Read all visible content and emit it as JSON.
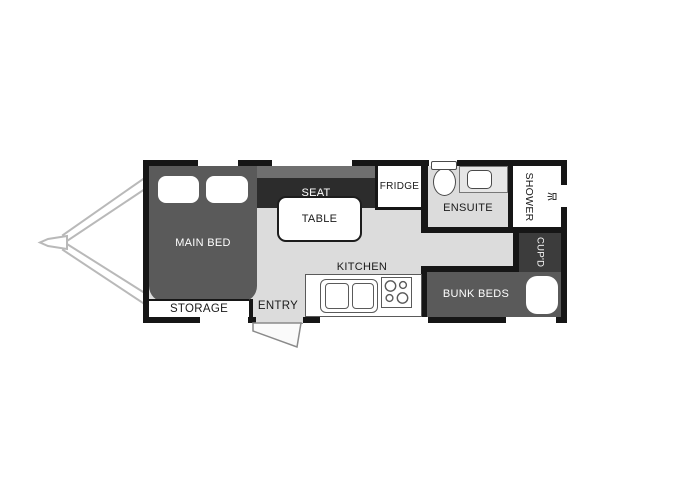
{
  "title": "Caravan Floor Plan",
  "colors": {
    "wall": "#161616",
    "floor": "#dcdcdc",
    "bed_fill": "#5a5a5a",
    "seat_fill": "#2c2c2c",
    "seat_back_fill": "#6f6f6f",
    "cupboard_fill": "#3c3c3c",
    "fixture_fill": "#ffffff",
    "hitch_stroke": "#b9b9b9"
  },
  "rooms": {
    "main_bed": {
      "label": "MAIN BED"
    },
    "storage": {
      "label": "STORAGE"
    },
    "entry": {
      "label": "ENTRY"
    },
    "seat": {
      "label": "SEAT"
    },
    "table": {
      "label": "TABLE"
    },
    "fridge": {
      "label": "FRIDGE"
    },
    "kitchen": {
      "label": "KITCHEN"
    },
    "ensuite": {
      "label": "ENSUITE"
    },
    "shower": {
      "label": "SHOWER"
    },
    "cupboard": {
      "label": "CUP'D"
    },
    "bunk_beds": {
      "label": "BUNK BEDS"
    }
  },
  "icons": {
    "shower_head": "shower-head-icon",
    "stove": "stove-burners-icon",
    "toilet": "toilet-icon",
    "sink": "sink-icon"
  }
}
